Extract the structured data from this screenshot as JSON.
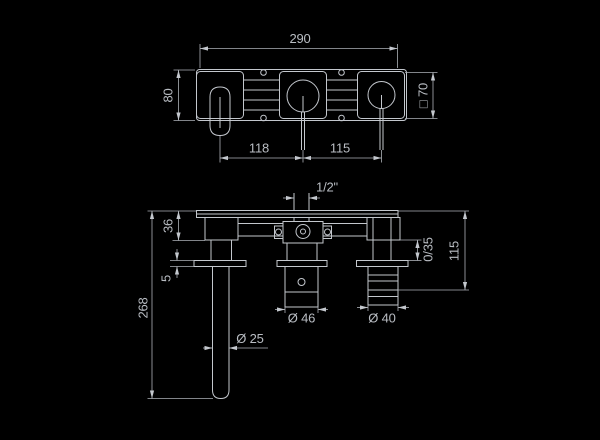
{
  "drawing": {
    "front_view": {
      "overall_width": "290",
      "overall_height": "80",
      "escutcheon_square": "□ 70",
      "spout_to_mixer": "118",
      "mixer_to_handle": "115"
    },
    "side_view": {
      "thread_size": "1/2\"",
      "body_depth": "36",
      "plate_thickness": "5",
      "spout_drop_length": "268",
      "spout_diameter": "Ø 25",
      "mixer_handle_diameter": "Ø 46",
      "volume_handle_diameter": "Ø 40",
      "adjustment_range": "0/35",
      "projection_height": "115"
    },
    "colors": {
      "background": "#000000",
      "line": "#c3c7cd",
      "text": "#b9bdc3"
    }
  }
}
